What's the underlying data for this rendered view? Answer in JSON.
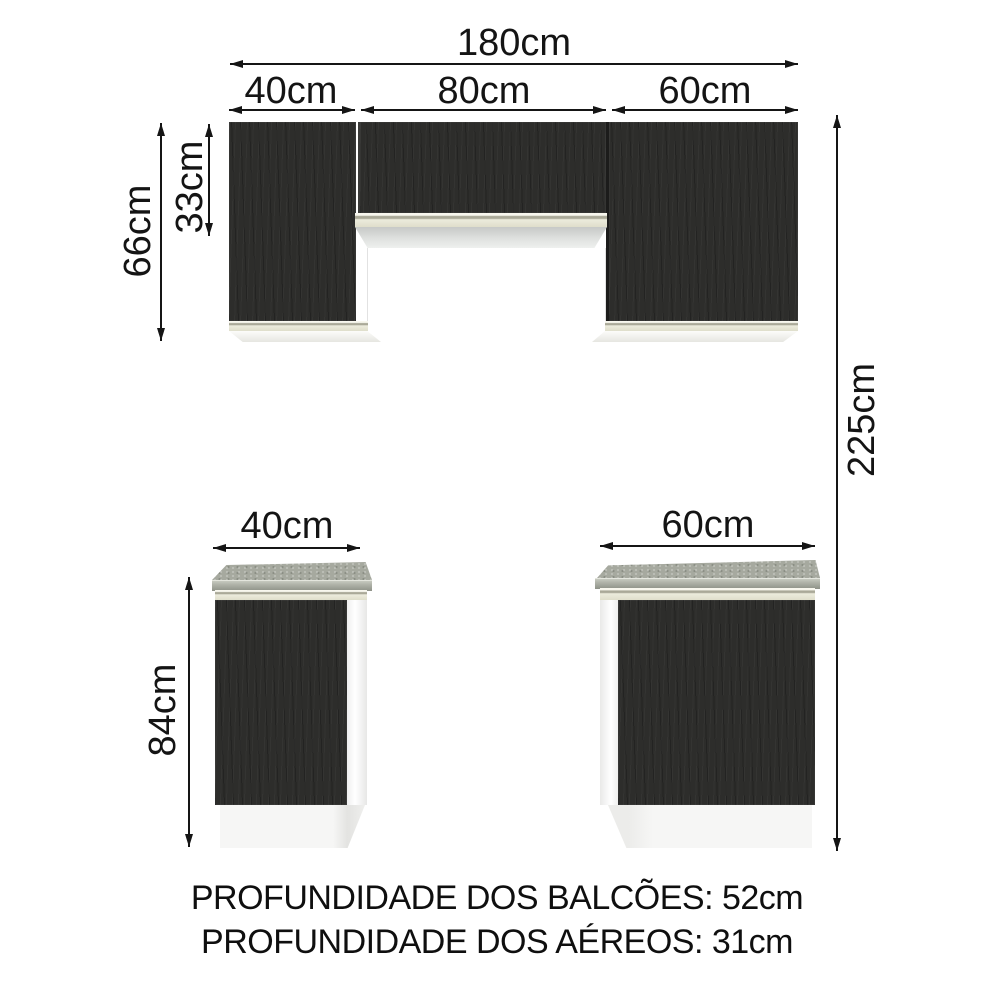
{
  "dimension_labels": {
    "total_width": "180cm",
    "upper_left_width": "40cm",
    "upper_middle_width": "80cm",
    "upper_right_width": "60cm",
    "upper_full_height": "66cm",
    "upper_middle_height": "33cm",
    "total_height": "225cm",
    "base_height": "84cm",
    "base_left_width": "40cm",
    "base_right_width": "60cm"
  },
  "footer": {
    "counters_depth": "PROFUNDIDADE DOS BALCÕES: 52cm",
    "wall_cabinets_depth": "PROFUNDIDADE DOS AÉREOS: 31cm"
  },
  "colors": {
    "background": "#ffffff",
    "door_dark": "#2d2d2b",
    "trim_cream": "#ecebdc",
    "countertop_gray": "#a6a99f",
    "panel_white": "#f6f6f5",
    "dimension_line": "#151515",
    "text": "#141414"
  }
}
